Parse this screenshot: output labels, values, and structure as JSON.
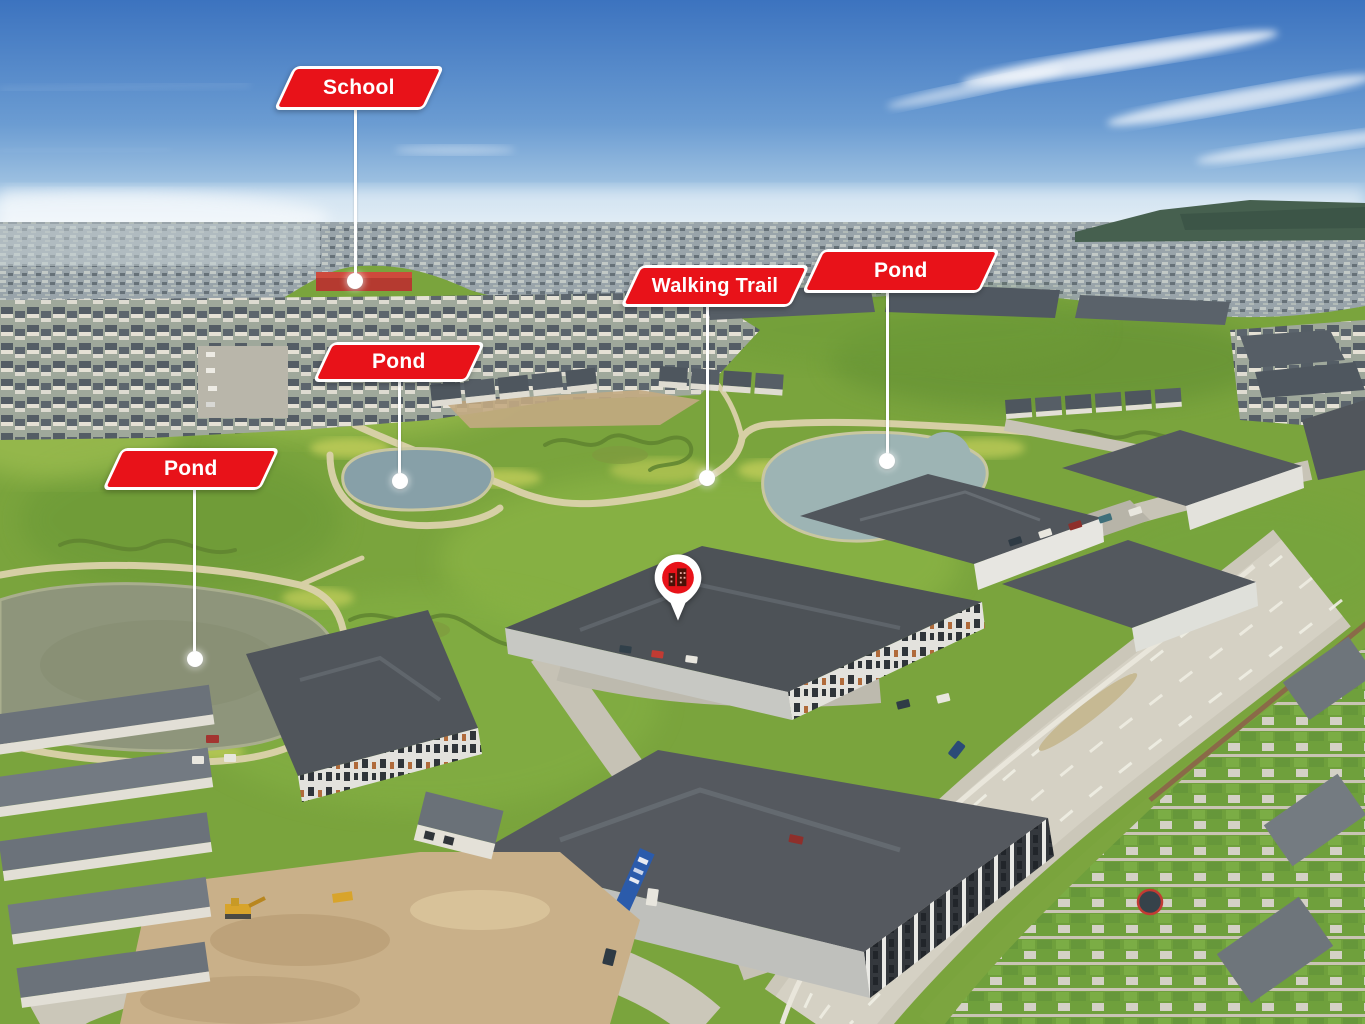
{
  "callouts": [
    {
      "id": "school",
      "label": "School"
    },
    {
      "id": "walking-trail",
      "label": "Walking Trail"
    },
    {
      "id": "pond-north",
      "label": "Pond"
    },
    {
      "id": "pond-middle",
      "label": "Pond"
    },
    {
      "id": "pond-west",
      "label": "Pond"
    }
  ],
  "marker": {
    "icon": "building-icon"
  },
  "colors": {
    "label_red": "#e81219",
    "label_border": "#ffffff",
    "label_text": "#ffffff",
    "leader_line": "#ffffff"
  }
}
